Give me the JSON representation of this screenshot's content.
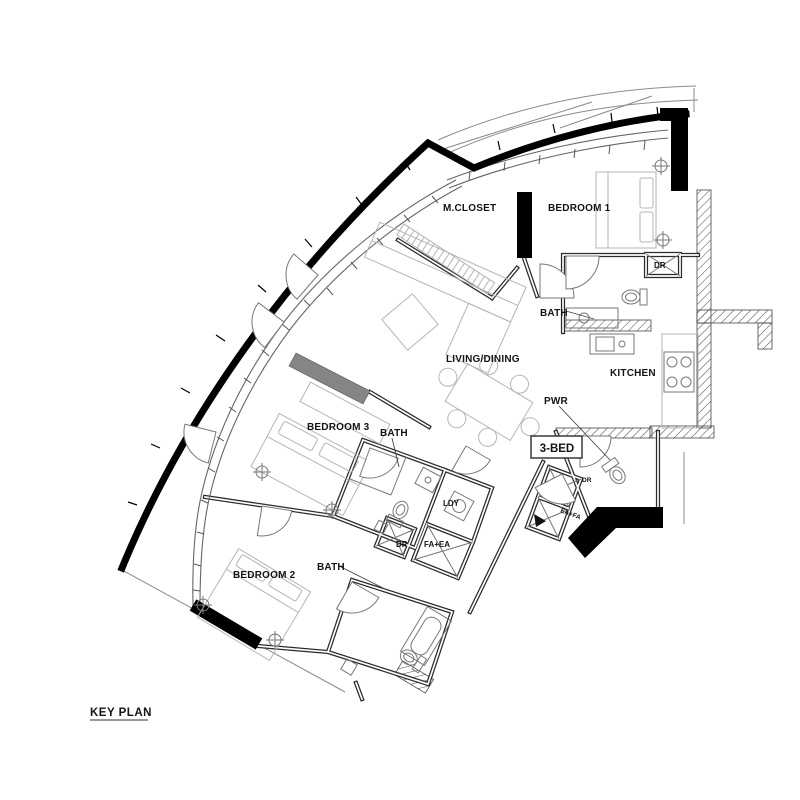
{
  "drawing": {
    "title": "KEY PLAN",
    "unit_type": "3-BED"
  },
  "rooms": {
    "m_closet": "M.CLOSET",
    "bedroom1": "BEDROOM 1",
    "bath1": "BATH",
    "living_dining": "LIVING/DINING",
    "kitchen": "KITCHEN",
    "pwr": "PWR",
    "bedroom3": "BEDROOM 3",
    "bath3": "BATH",
    "ldy": "LDY",
    "bedroom2": "BEDROOM 2",
    "bath2": "BATH"
  },
  "closets_shafts": {
    "dr_bath1": "DR",
    "dr_service": "DR",
    "fa_ea_service": "FA+EA",
    "dr_entry": "DR",
    "ea_fa_entry": "EA+FA"
  },
  "colors": {
    "shell_wall": "#000000",
    "interior_wall": "#2b2b2b",
    "feature_wall_gray": "#858585",
    "furniture_line": "#b5b5b5",
    "background": "#ffffff"
  }
}
